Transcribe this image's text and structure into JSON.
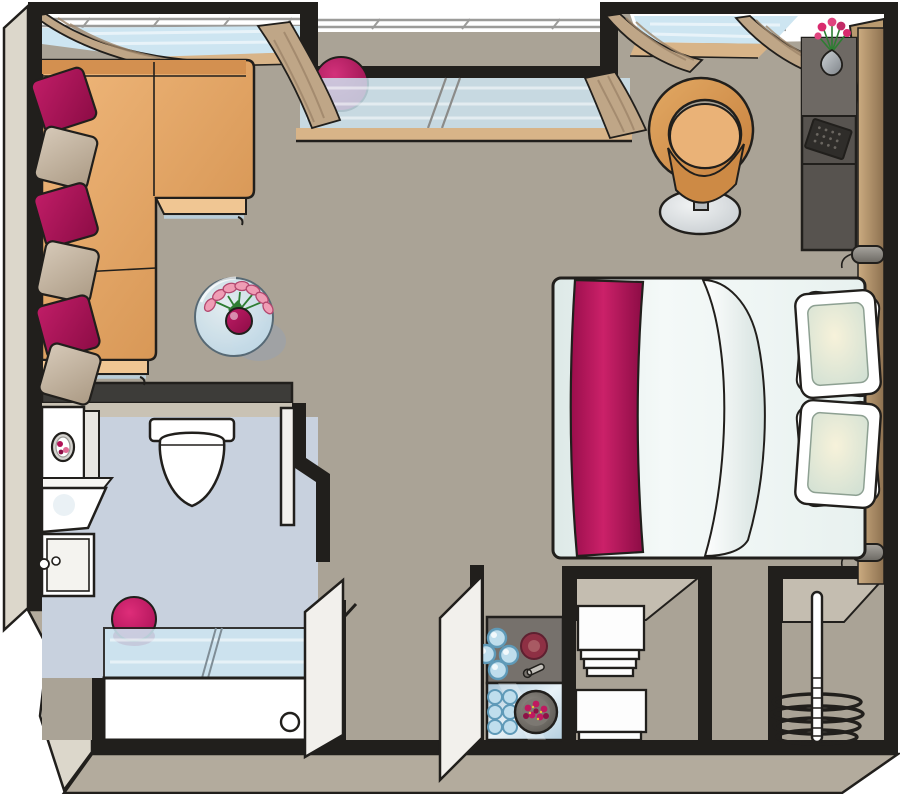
{
  "scene": {
    "type": "floor-plan-illustration",
    "view": "top-down-axonometric",
    "rooms": [
      "living-room",
      "bedroom-area",
      "bathroom",
      "kitchenette",
      "entry-corridor",
      "wardrobe-closet",
      "linen-closet",
      "balcony-window-front"
    ]
  },
  "palette": {
    "floor": "#aaa396",
    "wall": "#211f1c",
    "outer_face": "#dcd7cb",
    "bevel": "#b3ab9d",
    "bath_floor": "#c8d1de",
    "bath_wall": "#c9c2b4",
    "counter_dark": "#3d3c39",
    "glass": "#cde5f1",
    "sill": "#d8b488",
    "curtain": "#bfa687",
    "curtain_fold": "#9d8569",
    "railing": "#9b9b99",
    "sofa": "#e2a465",
    "sofa_light": "#f0c693",
    "sofa_back": "#d39050",
    "lip_blue": "#b9cdd8",
    "magenta": "#b11357",
    "magenta_dark": "#8c0d45",
    "pillow_beige": "#c9baa7",
    "bed_white": "#eff5f3",
    "headboard": "#bf9e74",
    "tan_wall": "#b99a6f",
    "console": "#57534f",
    "console_top": "#6e6964",
    "device": "#2f2d2a",
    "lamp": "#8f8c87",
    "chair": "#d69750",
    "chair_inner": "#eab277",
    "chair_seat": "#cd8a45",
    "base_gray": "#dfe3e5",
    "stove": "#76716c",
    "burner_blue": "#bfdeed",
    "burner_ring": "#5f9ab8",
    "hotplate_red": "#8e3044",
    "steel": "#bdd5e4",
    "berry": "#bf1960",
    "plate": "#6f6b66",
    "stool": "#cb1164",
    "towel": "#fdfdfd",
    "door": "#f2f0ec",
    "slant_face": "#c4bdb0",
    "white": "#ffffff",
    "green": "#2e7d32",
    "tulip_pink": "#ef9db5"
  },
  "inventory": {
    "living_room": {
      "sofa_pillow_count": 6,
      "items": [
        "corner-sofa",
        "glass-coffee-table",
        "tulip-bouquet-vase",
        "tub-chair",
        "console-desk",
        "laptop",
        "flower-vase",
        "decor-ball"
      ]
    },
    "bedroom": {
      "bed_pillow_count": 2,
      "wall_lamp_count": 2,
      "items": [
        "double-bed",
        "bed-runner",
        "duvet-fold",
        "headboard-panel"
      ]
    },
    "bathroom": {
      "items": [
        "washing-machine",
        "wall-shelf",
        "sink",
        "cabinet",
        "toilet",
        "stool",
        "shower-screen",
        "bathtub",
        "drain"
      ]
    },
    "kitchenette": {
      "blue_burner_count": 4,
      "egg_tray_circle_count": 6,
      "items": [
        "cooktop",
        "hotplate",
        "steel-counter",
        "egg-tray",
        "berry-plate",
        "bottle-opener"
      ]
    },
    "closets": {
      "hanger_count": 4,
      "towel_stack_count": 2,
      "items": [
        "linen-shelves",
        "clothes-rail"
      ]
    },
    "balcony": {
      "window_count": 3,
      "curtain_count": 5,
      "items": [
        "balcony-railing",
        "window-glass",
        "window-sill"
      ]
    }
  }
}
